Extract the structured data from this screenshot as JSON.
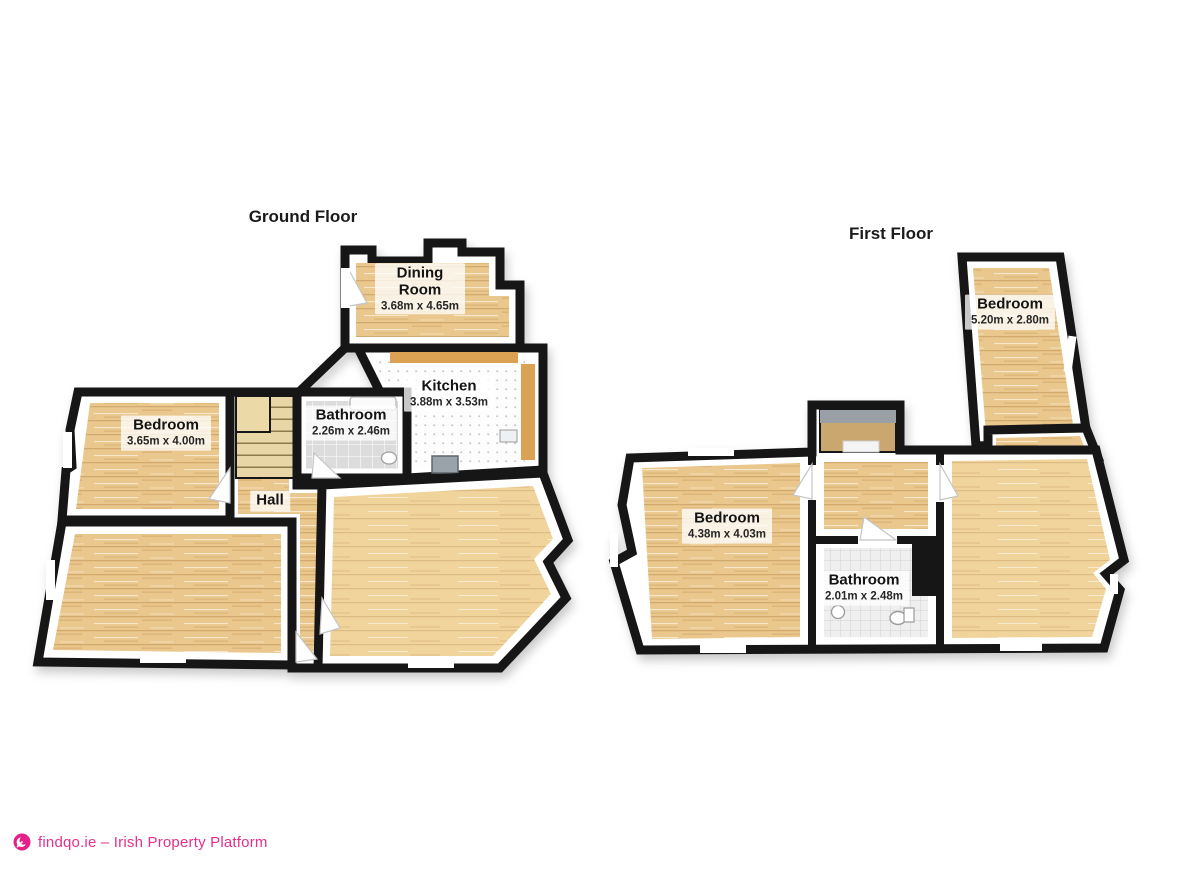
{
  "ground": {
    "title": "Ground Floor",
    "rooms": {
      "dining": {
        "name": "Dining Room",
        "dims": "3.68m x 4.65m"
      },
      "kitchen": {
        "name": "Kitchen",
        "dims": "3.88m x 3.53m"
      },
      "bathroom": {
        "name": "Bathroom",
        "dims": "2.26m x 2.46m"
      },
      "bedroom": {
        "name": "Bedroom",
        "dims": "3.65m x 4.00m"
      },
      "hall": {
        "name": "Hall"
      }
    }
  },
  "first": {
    "title": "First Floor",
    "rooms": {
      "bedroom_top": {
        "name": "Bedroom",
        "dims": "5.20m x 2.80m"
      },
      "bedroom_left": {
        "name": "Bedroom",
        "dims": "4.38m x 4.03m"
      },
      "bathroom": {
        "name": "Bathroom",
        "dims": "2.01m x 2.48m"
      }
    }
  },
  "footer": {
    "text": "findqo.ie – Irish Property Platform"
  },
  "colors": {
    "brand_pink": "#e5308c",
    "wall_black": "#161616",
    "wood_floor": "#eac88d",
    "counter_orange": "#dca253"
  }
}
